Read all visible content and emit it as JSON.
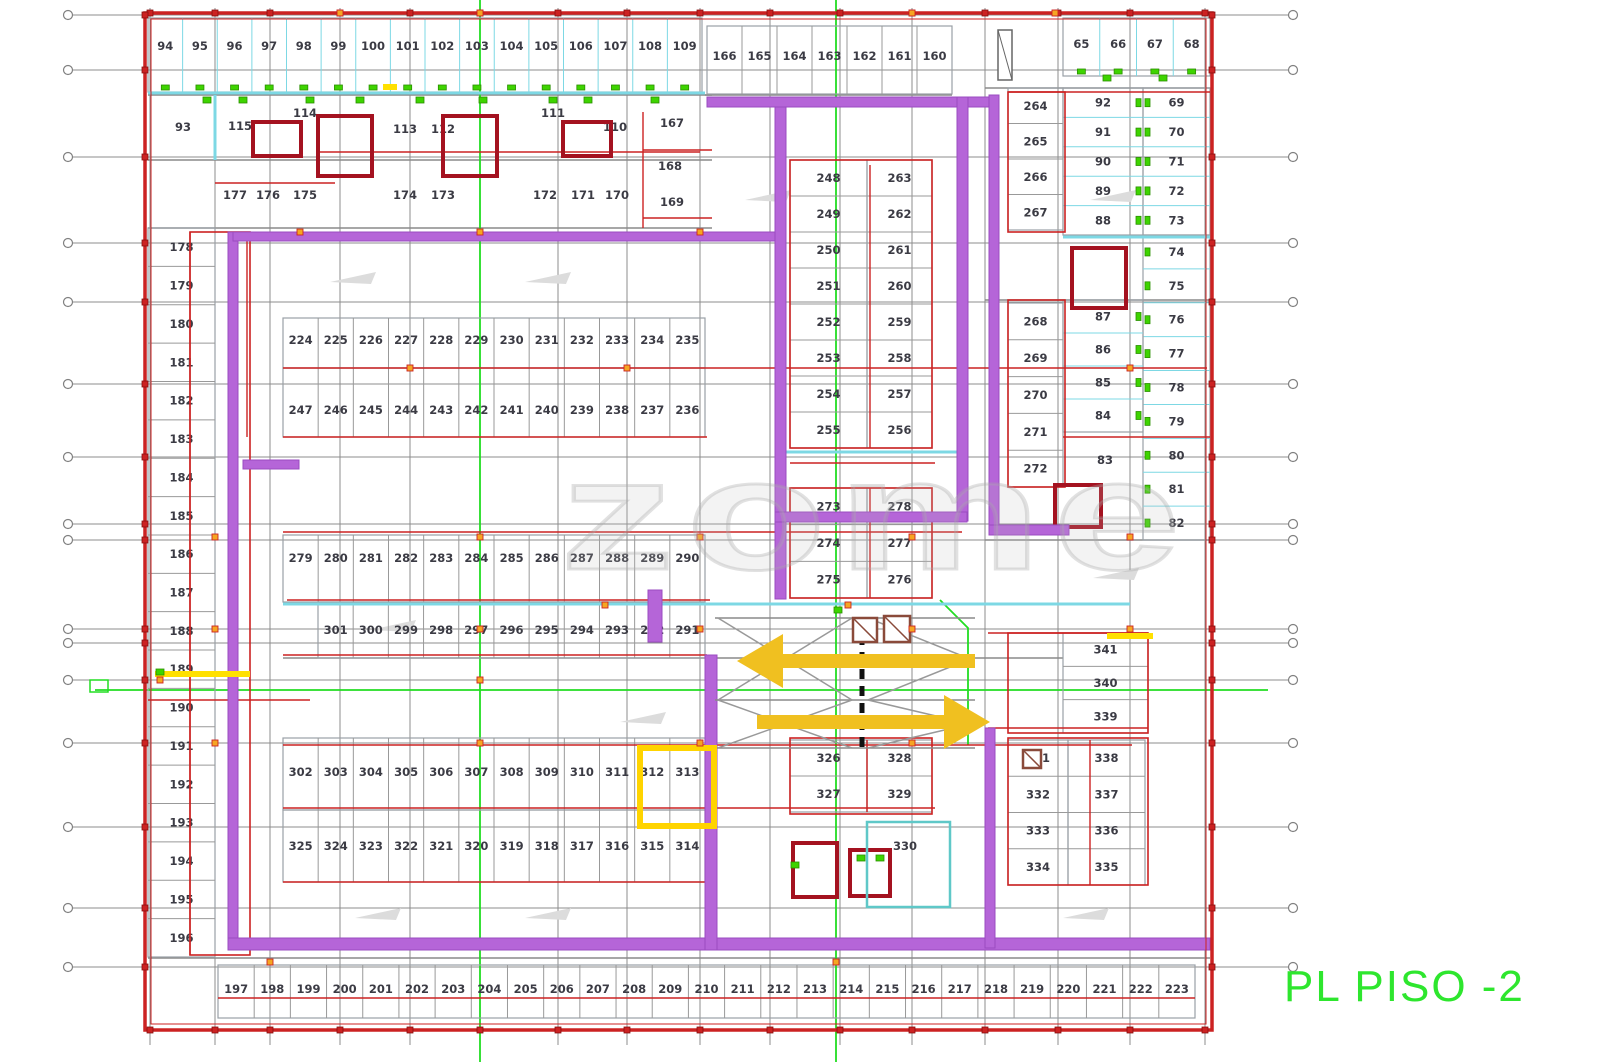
{
  "title": {
    "text": "PL PISO -2",
    "color": "#2ee62e"
  },
  "watermark": {
    "text": "zome"
  },
  "colors": {
    "wall_purple": "#b565d8",
    "line_red": "#cc2222",
    "dark_red": "#a41220",
    "cyan": "#7dd8e4",
    "teal": "#5fc8c8",
    "green": "#22dd22",
    "door_green": "#3ed400",
    "arrow_yellow": "#f0c020",
    "highlight_yellow": "#ffd400",
    "grid_gray": "#8c8c8c",
    "stall_gray": "#9aa0a6",
    "label_ink": "#3b3b44",
    "orange_dot": "#f5a623"
  },
  "plan": {
    "border": {
      "outer": [
        145,
        13,
        1067,
        1017
      ],
      "inner": [
        151,
        19,
        1055,
        1005
      ]
    },
    "grid": {
      "h_ys": [
        15,
        70,
        157,
        243,
        302,
        384,
        457,
        524,
        540,
        629,
        643,
        680,
        743,
        827,
        908,
        967
      ],
      "v_xs": [
        150,
        215,
        270,
        340,
        410,
        480,
        558,
        627,
        700,
        770,
        840,
        912,
        985,
        1058,
        1130,
        1205
      ],
      "h_x1": 72,
      "h_x2": 1289,
      "circle_x1": 68,
      "circle_x2": 1293,
      "v_y1": 8,
      "v_y2": 1045
    },
    "green_lines": {
      "verticals": [
        480,
        836
      ],
      "horizontal": {
        "y": 690,
        "x1": 95,
        "x2": 1268
      },
      "polyline": [
        [
          940,
          600
        ],
        [
          968,
          628
        ],
        [
          968,
          745
        ]
      ],
      "small_box": [
        90,
        680,
        18,
        12
      ]
    },
    "rows": [
      {
        "x": 148,
        "y": 18,
        "w": 554,
        "h": 74,
        "dir": "h",
        "dy": 32,
        "div": "#7dd8e4",
        "doors": "bottom",
        "nums": [
          "94",
          "95",
          "96",
          "97",
          "98",
          "99",
          "100",
          "101",
          "102",
          "103",
          "104",
          "105",
          "106",
          "107",
          "108",
          "109"
        ]
      },
      {
        "x": 707,
        "y": 26,
        "w": 245,
        "h": 68,
        "dir": "h",
        "dy": 34,
        "div": "#999999",
        "doors": null,
        "nums": [
          "166",
          "165",
          "164",
          "163",
          "162",
          "161",
          "160"
        ]
      },
      {
        "x": 1063,
        "y": 18,
        "w": 147,
        "h": 58,
        "dir": "h",
        "dy": 30,
        "div": "#7dd8e4",
        "doors": "bottom",
        "nums": [
          "65",
          "66",
          "67",
          "68"
        ]
      },
      {
        "x": 1063,
        "y": 88,
        "w": 80,
        "h": 147,
        "dir": "v",
        "div": "#7dd8e4",
        "doors": "right",
        "nums": [
          "92",
          "91",
          "90",
          "89",
          "88"
        ]
      },
      {
        "x": 1143,
        "y": 88,
        "w": 67,
        "h": 147,
        "dir": "v",
        "div": "#7dd8e4",
        "doors": "left",
        "nums": [
          "69",
          "70",
          "71",
          "72",
          "73"
        ]
      },
      {
        "x": 1143,
        "y": 235,
        "w": 67,
        "h": 305,
        "dir": "v",
        "div": "#7dd8e4",
        "doors": "left",
        "nums": [
          "74",
          "75",
          "76",
          "77",
          "78",
          "79",
          "80",
          "81",
          "82"
        ]
      },
      {
        "x": 1063,
        "y": 300,
        "w": 80,
        "h": 132,
        "dir": "v",
        "div": "#7dd8e4",
        "doors": "right",
        "nums": [
          "87",
          "86",
          "85",
          "84"
        ]
      },
      {
        "x": 1008,
        "y": 88,
        "w": 55,
        "h": 142,
        "dir": "v",
        "div": "#999999",
        "doors": null,
        "nums": [
          "264",
          "265",
          "266",
          "267"
        ]
      },
      {
        "x": 1008,
        "y": 303,
        "w": 55,
        "h": 184,
        "dir": "v",
        "div": "#999999",
        "doors": null,
        "nums": [
          "268",
          "269",
          "270",
          "271",
          "272"
        ]
      },
      {
        "x": 283,
        "y": 318,
        "w": 422,
        "h": 50,
        "dir": "h",
        "dy": 26,
        "div": "#999999",
        "doors": null,
        "nums": [
          "224",
          "225",
          "226",
          "227",
          "228",
          "229",
          "230",
          "231",
          "232",
          "233",
          "234",
          "235"
        ]
      },
      {
        "x": 283,
        "y": 368,
        "w": 422,
        "h": 69,
        "dir": "h",
        "dy": 46,
        "div": "#999999",
        "doors": null,
        "nums": [
          "247",
          "246",
          "245",
          "244",
          "243",
          "242",
          "241",
          "240",
          "239",
          "238",
          "237",
          "236"
        ]
      },
      {
        "x": 790,
        "y": 160,
        "w": 77,
        "h": 288,
        "dir": "v",
        "div": "#999999",
        "doors": null,
        "nums": [
          "248",
          "249",
          "250",
          "251",
          "252",
          "253",
          "254",
          "255"
        ]
      },
      {
        "x": 867,
        "y": 160,
        "w": 65,
        "h": 288,
        "dir": "v",
        "div": "#999999",
        "doors": null,
        "nums": [
          "263",
          "262",
          "261",
          "260",
          "259",
          "258",
          "257",
          "256"
        ]
      },
      {
        "x": 790,
        "y": 488,
        "w": 77,
        "h": 110,
        "dir": "v",
        "div": "#999999",
        "doors": null,
        "nums": [
          "273",
          "274",
          "275"
        ]
      },
      {
        "x": 867,
        "y": 488,
        "w": 65,
        "h": 110,
        "dir": "v",
        "div": "#999999",
        "doors": null,
        "nums": [
          "278",
          "277",
          "276"
        ]
      },
      {
        "x": 283,
        "y": 535,
        "w": 422,
        "h": 67,
        "dir": "h",
        "dy": 27,
        "div": "#999999",
        "doors": null,
        "nums": [
          "279",
          "280",
          "281",
          "282",
          "283",
          "284",
          "285",
          "286",
          "287",
          "288",
          "289",
          "290"
        ]
      },
      {
        "x": 318,
        "y": 602,
        "w": 387,
        "h": 56,
        "dir": "h",
        "dy": 32,
        "div": "#999999",
        "doors": null,
        "nums": [
          "301",
          "300",
          "299",
          "298",
          "297",
          "296",
          "295",
          "294",
          "293",
          "292",
          "291"
        ]
      },
      {
        "x": 1063,
        "y": 633,
        "w": 85,
        "h": 100,
        "dir": "v",
        "div": "#999999",
        "doors": null,
        "nums": [
          "341",
          "340",
          "339"
        ]
      },
      {
        "x": 283,
        "y": 738,
        "w": 422,
        "h": 72,
        "dir": "h",
        "dy": 38,
        "div": "#999999",
        "doors": null,
        "nums": [
          "302",
          "303",
          "304",
          "305",
          "306",
          "307",
          "308",
          "309",
          "310",
          "311",
          "312",
          "313"
        ]
      },
      {
        "x": 283,
        "y": 810,
        "w": 422,
        "h": 72,
        "dir": "h",
        "dy": 40,
        "div": "#999999",
        "doors": null,
        "nums": [
          "325",
          "324",
          "323",
          "322",
          "321",
          "320",
          "319",
          "318",
          "317",
          "316",
          "315",
          "314"
        ]
      },
      {
        "x": 790,
        "y": 740,
        "w": 77,
        "h": 72,
        "dir": "v",
        "div": "#999999",
        "doors": null,
        "nums": [
          "326",
          "327"
        ]
      },
      {
        "x": 867,
        "y": 740,
        "w": 65,
        "h": 72,
        "dir": "v",
        "div": "#999999",
        "doors": null,
        "nums": [
          "328",
          "329"
        ]
      },
      {
        "x": 1008,
        "y": 740,
        "w": 60,
        "h": 145,
        "dir": "v",
        "div": "#999999",
        "doors": null,
        "nums": [
          "331",
          "332",
          "333",
          "334"
        ]
      },
      {
        "x": 1068,
        "y": 740,
        "w": 77,
        "h": 145,
        "dir": "v",
        "div": "#999999",
        "doors": null,
        "nums": [
          "338",
          "337",
          "336",
          "335"
        ]
      },
      {
        "x": 148,
        "y": 228,
        "w": 67,
        "h": 729,
        "dir": "v",
        "div": "#999999",
        "doors": null,
        "nums": [
          "178",
          "179",
          "180",
          "181",
          "182",
          "183",
          "184",
          "185",
          "186",
          "187",
          "188",
          "189",
          "190",
          "191",
          "192",
          "193",
          "194",
          "195",
          "196"
        ]
      },
      {
        "x": 218,
        "y": 965,
        "w": 977,
        "h": 53,
        "dir": "h",
        "dy": 28,
        "div": "#999999",
        "doors": null,
        "nums": [
          "197",
          "198",
          "199",
          "200",
          "201",
          "202",
          "203",
          "204",
          "205",
          "206",
          "207",
          "208",
          "209",
          "210",
          "211",
          "212",
          "213",
          "214",
          "215",
          "216",
          "217",
          "218",
          "219",
          "220",
          "221",
          "222",
          "223"
        ]
      }
    ],
    "free_labels": [
      [
        "93",
        183,
        131
      ],
      [
        "115",
        240,
        130
      ],
      [
        "114",
        305,
        117
      ],
      [
        "113",
        405,
        133
      ],
      [
        "112",
        443,
        133
      ],
      [
        "111",
        553,
        117
      ],
      [
        "110",
        615,
        131
      ],
      [
        "167",
        672,
        127
      ],
      [
        "168",
        670,
        170
      ],
      [
        "169",
        672,
        206
      ],
      [
        "177",
        235,
        199
      ],
      [
        "176",
        268,
        199
      ],
      [
        "175",
        305,
        199
      ],
      [
        "174",
        405,
        199
      ],
      [
        "173",
        443,
        199
      ],
      [
        "172",
        545,
        199
      ],
      [
        "171",
        583,
        199
      ],
      [
        "170",
        617,
        199
      ],
      [
        "83",
        1105,
        464
      ],
      [
        "330",
        905,
        850
      ]
    ],
    "walls": [
      [
        228,
        232,
        10,
        716
      ],
      [
        228,
        938,
        982,
        12
      ],
      [
        233,
        232,
        542,
        9
      ],
      [
        775,
        97,
        11,
        502
      ],
      [
        707,
        97,
        282,
        10
      ],
      [
        957,
        97,
        11,
        424
      ],
      [
        775,
        512,
        192,
        10
      ],
      [
        989,
        95,
        10,
        438
      ],
      [
        989,
        525,
        80,
        10
      ],
      [
        705,
        655,
        12,
        295
      ],
      [
        985,
        728,
        10,
        220
      ],
      [
        648,
        590,
        14,
        52
      ],
      [
        243,
        460,
        56,
        9
      ]
    ],
    "red_h": [
      [
        320,
        700,
        152
      ],
      [
        643,
        712,
        150
      ],
      [
        215,
        335,
        183
      ],
      [
        643,
        712,
        218
      ],
      [
        283,
        1207,
        368
      ],
      [
        283,
        707,
        437
      ],
      [
        1063,
        1210,
        437
      ],
      [
        283,
        962,
        532
      ],
      [
        287,
        710,
        600
      ],
      [
        283,
        707,
        655
      ],
      [
        283,
        1132,
        745
      ],
      [
        283,
        935,
        808
      ],
      [
        283,
        707,
        882
      ],
      [
        218,
        1195,
        998
      ],
      [
        790,
        935,
        463
      ],
      [
        988,
        1148,
        633
      ],
      [
        988,
        1148,
        728
      ],
      [
        148,
        310,
        700
      ],
      [
        1008,
        1210,
        92
      ]
    ],
    "red_v": [
      [
        190,
        232,
        955
      ],
      [
        247,
        232,
        437
      ],
      [
        870,
        165,
        448
      ],
      [
        870,
        488,
        598
      ],
      [
        867,
        740,
        812
      ],
      [
        1090,
        740,
        885
      ],
      [
        643,
        112,
        228
      ]
    ],
    "red_boxes": [
      [
        790,
        160,
        142,
        288
      ],
      [
        790,
        488,
        142,
        110
      ],
      [
        790,
        738,
        142,
        76
      ],
      [
        1008,
        633,
        140,
        100
      ],
      [
        1008,
        738,
        140,
        147
      ],
      [
        1008,
        92,
        57,
        140
      ],
      [
        1008,
        300,
        57,
        187
      ],
      [
        190,
        232,
        60,
        723
      ]
    ],
    "dark_red_boxes": [
      [
        253,
        122,
        48,
        34
      ],
      [
        318,
        116,
        54,
        60
      ],
      [
        443,
        116,
        54,
        60
      ],
      [
        563,
        122,
        48,
        34
      ],
      [
        1072,
        248,
        54,
        60
      ],
      [
        1055,
        485,
        46,
        42
      ],
      [
        793,
        843,
        44,
        54
      ],
      [
        850,
        850,
        40,
        46
      ]
    ],
    "cyan_h": [
      [
        148,
        705,
        93
      ],
      [
        1063,
        1210,
        237
      ],
      [
        283,
        1130,
        604
      ],
      [
        775,
        965,
        452
      ]
    ],
    "cyan_v": [
      [
        215,
        95,
        160
      ]
    ],
    "cyan_boxes": [
      [
        867,
        822,
        83,
        85
      ]
    ],
    "gray_h": [
      [
        148,
        712,
        95
      ],
      [
        148,
        712,
        160
      ],
      [
        148,
        712,
        228
      ],
      [
        148,
        1210,
        958
      ],
      [
        705,
        952,
        95
      ],
      [
        985,
        1210,
        88
      ],
      [
        985,
        1210,
        300
      ],
      [
        985,
        1210,
        540
      ],
      [
        283,
        1063,
        658
      ]
    ],
    "small_rects": [
      [
        998,
        30,
        14,
        50
      ]
    ],
    "yellow_segs": [
      [
        155,
        250,
        674
      ],
      [
        1107,
        1153,
        636
      ],
      [
        383,
        397,
        87
      ]
    ],
    "orange_dots": [
      [
        215,
        537
      ],
      [
        480,
        537
      ],
      [
        700,
        537
      ],
      [
        912,
        537
      ],
      [
        1130,
        537
      ],
      [
        215,
        629
      ],
      [
        480,
        629
      ],
      [
        700,
        629
      ],
      [
        912,
        629
      ],
      [
        1130,
        629
      ],
      [
        160,
        680
      ],
      [
        480,
        680
      ],
      [
        215,
        743
      ],
      [
        480,
        743
      ],
      [
        700,
        743
      ],
      [
        912,
        743
      ],
      [
        340,
        13
      ],
      [
        480,
        13
      ],
      [
        912,
        13
      ],
      [
        1055,
        13
      ],
      [
        270,
        962
      ],
      [
        836,
        962
      ],
      [
        410,
        368
      ],
      [
        627,
        368
      ],
      [
        1130,
        368
      ],
      [
        300,
        232
      ],
      [
        480,
        232
      ],
      [
        700,
        232
      ],
      [
        848,
        605
      ],
      [
        605,
        605
      ]
    ],
    "green_dots": [
      [
        207,
        100
      ],
      [
        243,
        100
      ],
      [
        310,
        100
      ],
      [
        360,
        100
      ],
      [
        420,
        100
      ],
      [
        483,
        100
      ],
      [
        553,
        100
      ],
      [
        588,
        100
      ],
      [
        655,
        100
      ],
      [
        1107,
        78
      ],
      [
        1163,
        78
      ],
      [
        160,
        672
      ],
      [
        838,
        610
      ],
      [
        861,
        858
      ],
      [
        795,
        865
      ],
      [
        880,
        858
      ]
    ],
    "chevrons": [
      [
        330,
        272
      ],
      [
        525,
        272
      ],
      [
        745,
        190
      ],
      [
        620,
        712
      ],
      [
        1093,
        568
      ],
      [
        355,
        908
      ],
      [
        525,
        908
      ],
      [
        1063,
        908
      ],
      [
        1090,
        190
      ],
      [
        370,
        620
      ]
    ],
    "ramp": {
      "x1": 718,
      "x2": 852,
      "x3": 868,
      "x4": 970,
      "y1": 618,
      "y2": 700,
      "y3": 748,
      "dash_x": 862
    },
    "hatch_squares": [
      [
        853,
        618,
        24
      ],
      [
        884,
        616,
        26
      ],
      [
        1023,
        750,
        18
      ]
    ],
    "arrows": [
      {
        "dir": "left",
        "tip": 737,
        "tail": 975,
        "y": 661
      },
      {
        "dir": "right",
        "tip": 990,
        "tail": 757,
        "y": 722
      }
    ],
    "highlight_box": [
      640,
      748,
      74,
      78
    ]
  }
}
